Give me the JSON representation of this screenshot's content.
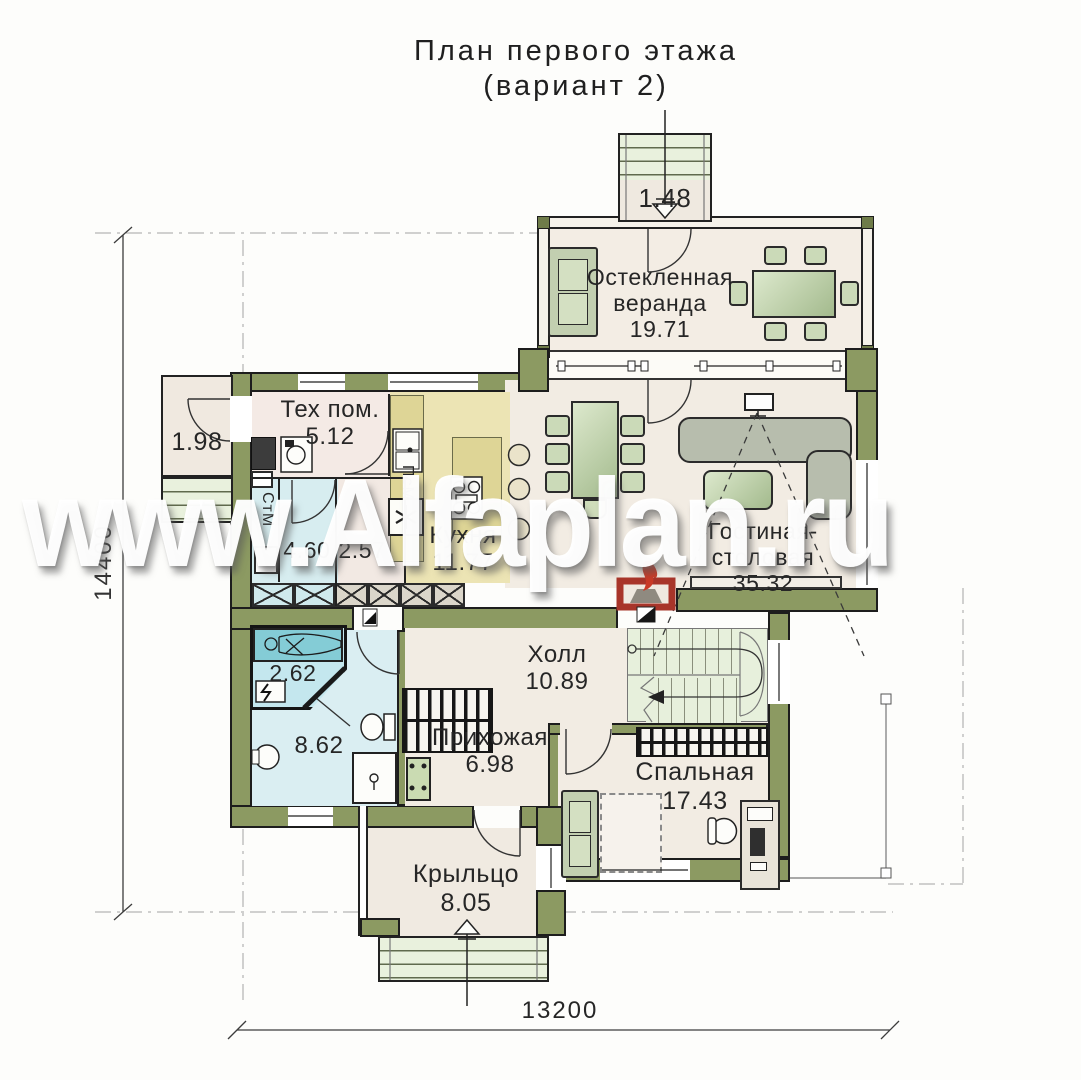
{
  "title": {
    "line1": "План первого этажа",
    "line2": "(вариант 2)"
  },
  "watermark": "www.Alfaplan.ru",
  "dimensions": {
    "height": "14400",
    "width": "13200"
  },
  "rooms": {
    "veranda": {
      "name1": "Остекленная",
      "name2": "веранда",
      "area": "19.71"
    },
    "veranda_steps": {
      "area": "1.48"
    },
    "terrace": {
      "area": "1.98"
    },
    "tech": {
      "name": "Тех пом.",
      "area": "5.12"
    },
    "kitchen": {
      "name": "Кухня",
      "area": "11.77"
    },
    "living": {
      "name1": "Гостиная-",
      "name2": "столовая",
      "area": "35.32"
    },
    "bath_laundry": {
      "area": "4.60"
    },
    "corridor": {
      "area": "2.57"
    },
    "sauna": {
      "area": "2.62"
    },
    "bathroom": {
      "area": "8.62"
    },
    "entry": {
      "name": "Прихожая",
      "area": "6.98"
    },
    "hall": {
      "name": "Холл",
      "area": "10.89"
    },
    "bedroom": {
      "name": "Спальная",
      "area": "17.43"
    },
    "porch": {
      "name": "Крыльцо",
      "area": "8.05"
    }
  },
  "appliances": {
    "washer": "СтМ",
    "dishwasher": "ПсМ"
  },
  "colors": {
    "wall_green": "#8c9a62",
    "fireplace_red": "#a8352a",
    "bath_blue": "#d7edf0",
    "kitchen_yellow": "#ece4b4"
  }
}
